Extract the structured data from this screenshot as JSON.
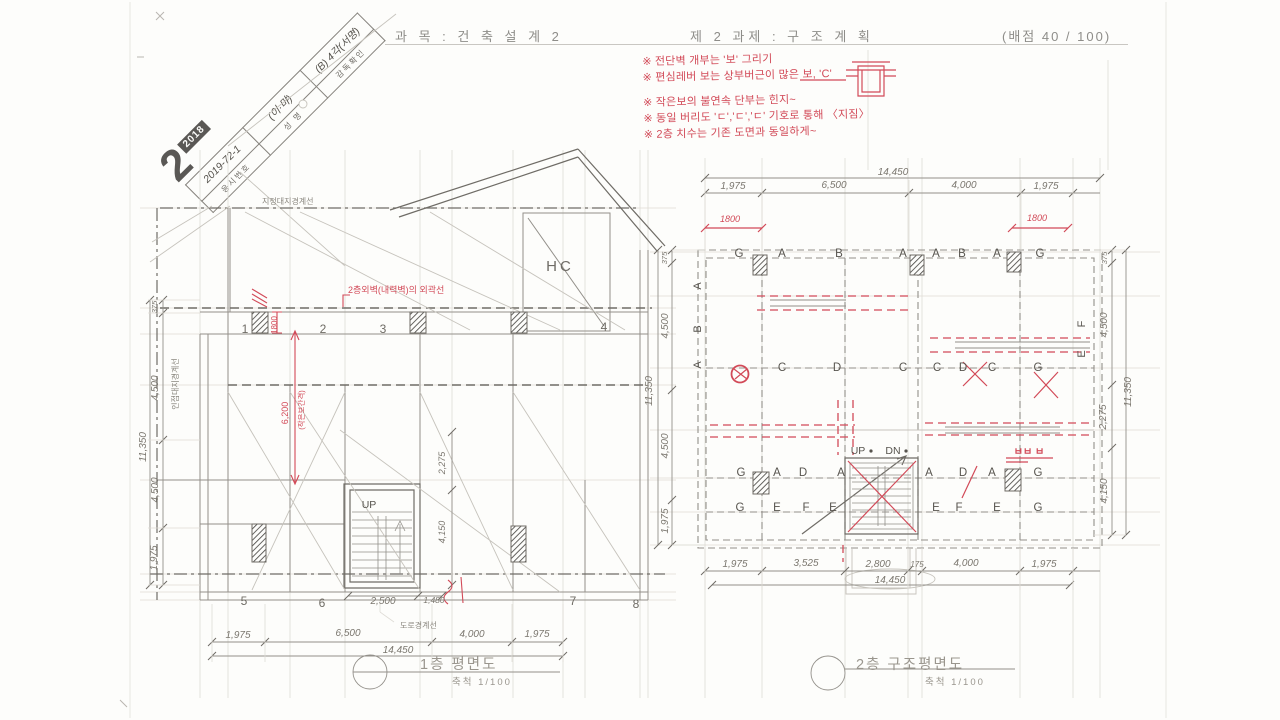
{
  "header": {
    "course": "과 목 : 건 축 설 계 2",
    "task": "제 2 과제 : 구 조 계 획",
    "score": "(배점  40 / 100)"
  },
  "stamp": {
    "big_number": "2",
    "year": "2018",
    "rows": [
      {
        "label": "응시번호",
        "value": "2019-72-1"
      },
      {
        "label": "성  명",
        "value": "(이·먀)"
      },
      {
        "label": "감독확인",
        "value": "(B) 4각(서명)"
      }
    ]
  },
  "red_notes": {
    "line1": "※ 전단벽 개부는 '보' 그리기",
    "line2": "※ 편심레버 보는 상부버근이 많은 보, 'C'",
    "line3": "※ 작은보의 불연속 단부는 힌지~",
    "line4": "※ 동일 버리도 'ㄷ','ㄷ','ㄷ' 기호로 통해 〈지짐〉",
    "line5": "※ 2층 치수는 기존 도면과 동일하게~"
  },
  "plan1": {
    "title": "1층 평면도",
    "scale": "축척 1/100",
    "labels": {
      "site_boundary": "지정대지경계선",
      "adjacent_boundary": "인접대지경계선",
      "road_boundary": "도로경계선",
      "hc": "HC",
      "up": "UP",
      "red_wall_outline": "2층외벽(내력벽)의 외곽선"
    },
    "grid_top": [
      "1",
      "2",
      "3",
      "4"
    ],
    "grid_bottom": [
      "5",
      "6",
      "7",
      "8"
    ],
    "dims_bottom": [
      "1,975",
      "6,500",
      "4,000",
      "1,975"
    ],
    "dims_bottom_total": "14,450",
    "dims_left": [
      "375",
      "4,500",
      "4,500",
      "1,975"
    ],
    "dims_left_total": "11,350",
    "dims_inner": [
      "2,275",
      "4,150"
    ],
    "dims_stair": [
      "2,500",
      "1,480"
    ],
    "red_dims": {
      "w1800": "1800",
      "h6200": "6,200",
      "note": "(작은보간격)"
    }
  },
  "plan2": {
    "title": "2층 구조평면도",
    "scale": "축척 1/100",
    "dims_top": [
      "1,975",
      "6,500",
      "4,000",
      "1,975"
    ],
    "dims_top_total": "14,450",
    "dims_bottom": [
      "1,975",
      "3,525",
      "2,800",
      "175",
      "4,000",
      "1,975"
    ],
    "dims_bottom_total": "14,450",
    "dims_left": [
      "375",
      "4,500",
      "4,500",
      "1,975"
    ],
    "dims_left_total": "11,350",
    "dims_right": [
      "375",
      "4,500",
      "2,275",
      "4,150"
    ],
    "dims_right_total": "11,350",
    "red_dim_left": "1800",
    "red_dim_right": "1800",
    "letters_top": [
      "G",
      "A",
      "B",
      "A",
      "A",
      "B",
      "A",
      "G"
    ],
    "letters_mid": [
      "C",
      "D",
      "C",
      "C",
      "D",
      "C",
      "G"
    ],
    "letters_row3": [
      "G",
      "A",
      "D",
      "A",
      "A",
      "D",
      "A",
      "G"
    ],
    "letters_row4": [
      "G",
      "E",
      "F",
      "E",
      "E",
      "F",
      "E",
      "G"
    ],
    "letters_side_left": [
      "A",
      "B",
      "A"
    ],
    "letters_side_right": [
      "F",
      "E"
    ],
    "stair": {
      "up": "UP",
      "dn": "DN"
    },
    "red_note": "ㅂㅂ ㅂ"
  },
  "colors": {
    "annotation_red": "#d24a58",
    "pencil_gray": "#8f8c85",
    "print_gray": "#8e8d89"
  }
}
